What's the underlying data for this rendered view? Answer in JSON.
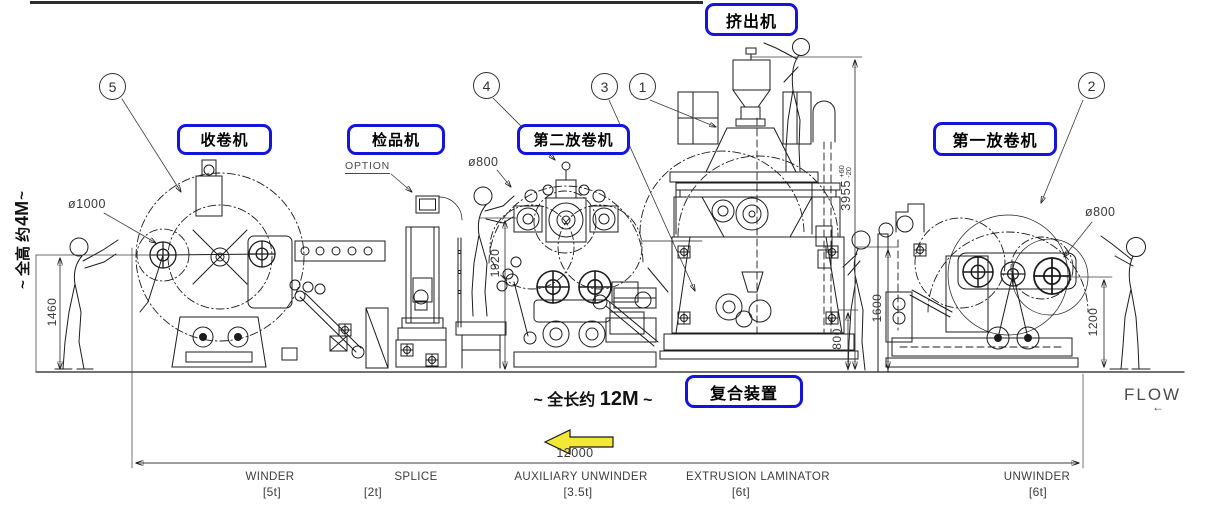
{
  "colors": {
    "callout_border": "#1414dd",
    "line_art": "#1c1c1c",
    "dimension_text": "#3a3a3a",
    "flow_highlight_arrow": "#f2e937"
  },
  "callouts": {
    "winder": "收卷机",
    "inspection": "检品机",
    "second_unwinder": "第二放卷机",
    "extruder": "挤出机",
    "first_unwinder": "第一放卷机",
    "laminator": "复合装置"
  },
  "balloons": {
    "b1": "1",
    "b2": "2",
    "b3": "3",
    "b4": "4",
    "b5": "5"
  },
  "dimensions": {
    "winder_roll_dia": "ø1000",
    "aux_roll_dia": "ø800",
    "unwinder_roll_dia": "ø800",
    "winder_height": "1460",
    "aux_height": "1920",
    "extruder_height": "3955",
    "extruder_height_tol_plus": "+60",
    "extruder_height_tol_minus": "-20",
    "laminator_height": "1600",
    "nip_height": "800",
    "unwinder_height": "1200",
    "total_length_mm": "12000"
  },
  "annotations": {
    "total_height_prefix": "~ 全高 约",
    "total_height_value": "4M",
    "total_height_suffix": " ~",
    "total_length_prefix": "~ 全长约",
    "total_length_value": "12M",
    "total_length_suffix": " ~",
    "option": "OPTION",
    "flow": "FLOW",
    "flow_direction": "←"
  },
  "stations": [
    {
      "name": "WINDER",
      "capacity": "[5t]"
    },
    {
      "name": "SPLICE",
      "capacity": "[2t]"
    },
    {
      "name": "AUXILIARY UNWINDER",
      "capacity": "[3.5t]"
    },
    {
      "name": "EXTRUSION LAMINATOR",
      "capacity": "[6t]"
    },
    {
      "name": "UNWINDER",
      "capacity": "[6t]"
    }
  ]
}
